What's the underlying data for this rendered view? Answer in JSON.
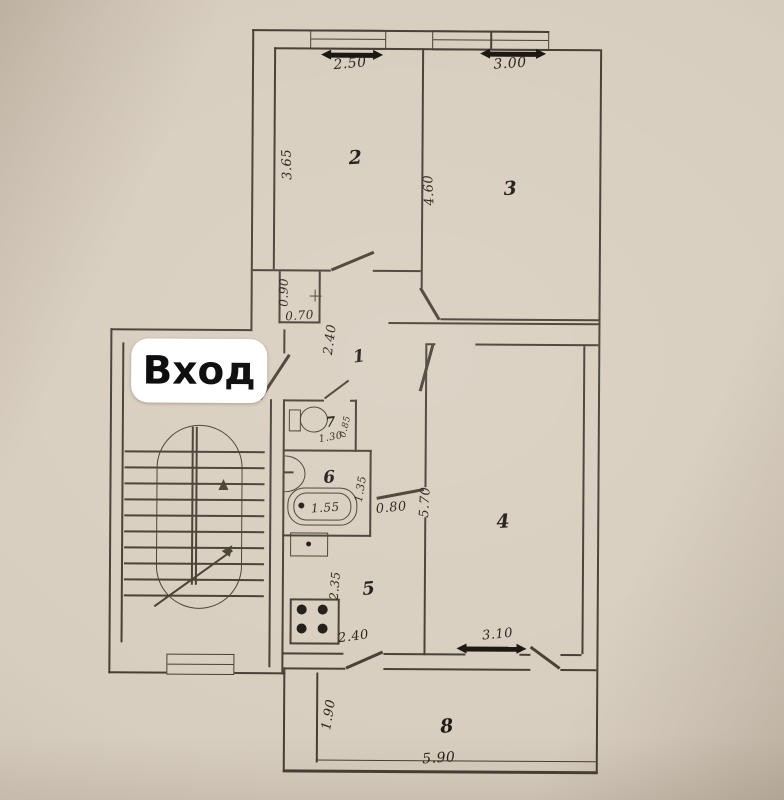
{
  "plan": {
    "entrance_label": "Вход",
    "rooms": {
      "hallway": {
        "number": "1",
        "depth": "2.40"
      },
      "room2": {
        "number": "2",
        "window_width": "2.50",
        "depth": "3.65"
      },
      "room3": {
        "number": "3",
        "window_width": "3.00",
        "depth": "4.60"
      },
      "room4": {
        "number": "4",
        "depth": "5.70",
        "window_width": "3.10",
        "door_width": "0.80"
      },
      "kitchen": {
        "number": "5",
        "depth": "2.35",
        "width": "2.40"
      },
      "bathroom": {
        "number": "6",
        "depth": "1.35",
        "bathtub_length": "1.55"
      },
      "wc": {
        "number": "7",
        "width": "1.30",
        "depth": "0.85"
      },
      "balcony": {
        "number": "8",
        "depth": "1.90",
        "width": "5.90"
      }
    },
    "closet": {
      "depth": "0.90",
      "width": "0.70"
    },
    "colors": {
      "paper": "#d8cebf",
      "ink": "#453d32",
      "window_fill": "#16120d",
      "label_bg": "#ffffff",
      "label_text": "#000000"
    }
  }
}
